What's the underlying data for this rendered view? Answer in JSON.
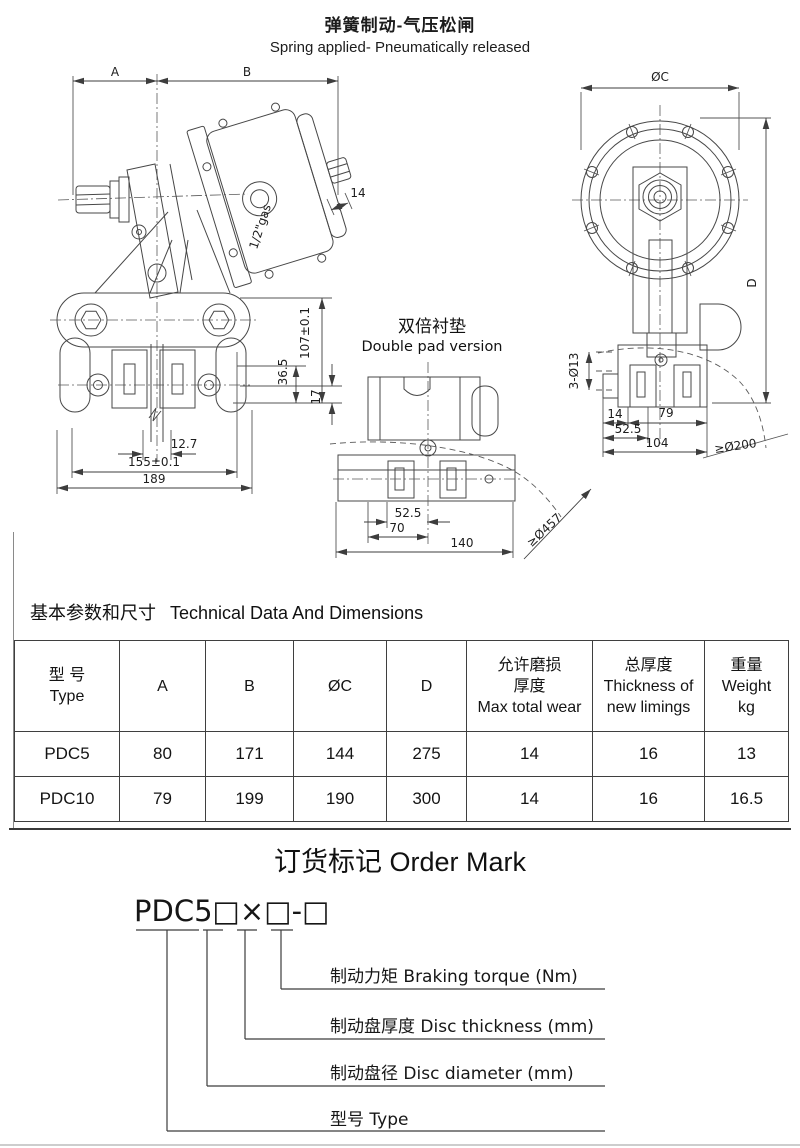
{
  "page": {
    "title_zh": "弹簧制动-气压松闸",
    "title_en": "Spring applied- Pneumatically released"
  },
  "drawings": {
    "side": {
      "dimA": "A",
      "dimB": "B",
      "d14": "14",
      "gas": "1/2\"gas",
      "d107": "107±0.1",
      "d365": "36.5",
      "d17": "17",
      "d127": "12.7",
      "d155": "155±0.1",
      "d189": "189"
    },
    "pad": {
      "title_zh": "双倍衬垫",
      "title_en": "Double pad version",
      "d525": "52.5",
      "d70": "70",
      "d140": "140",
      "disc": "≥Ø457"
    },
    "front": {
      "dC": "ØC",
      "dD": "D",
      "holes": "3-Ø13",
      "d14": "14",
      "d79": "79",
      "d525": "52.5",
      "d104": "104",
      "disc": "≥Ø200"
    }
  },
  "table": {
    "section_title_zh": "基本参数和尺寸",
    "section_title_en": "Technical Data And Dimensions",
    "headers": [
      [
        "型 号",
        "Type"
      ],
      [
        "A"
      ],
      [
        "B"
      ],
      [
        "ØC"
      ],
      [
        "D"
      ],
      [
        "允许磨损",
        "厚度",
        "Max total wear"
      ],
      [
        "总厚度",
        "Thickness of",
        "new limings"
      ],
      [
        "重量",
        "Weight",
        "kg"
      ]
    ],
    "rows": [
      [
        "PDC5",
        "80",
        "171",
        "144",
        "275",
        "14",
        "16",
        "13"
      ],
      [
        "PDC10",
        "79",
        "199",
        "190",
        "300",
        "14",
        "16",
        "16.5"
      ]
    ]
  },
  "order_mark": {
    "title": "订货标记 Order Mark",
    "code": "PDC5□×□-□",
    "callouts": [
      "制动力矩 Braking torque (Nm)",
      "制动盘厚度  Disc thickness (mm)",
      "制动盘径  Disc diameter (mm)",
      "型号 Type"
    ]
  }
}
